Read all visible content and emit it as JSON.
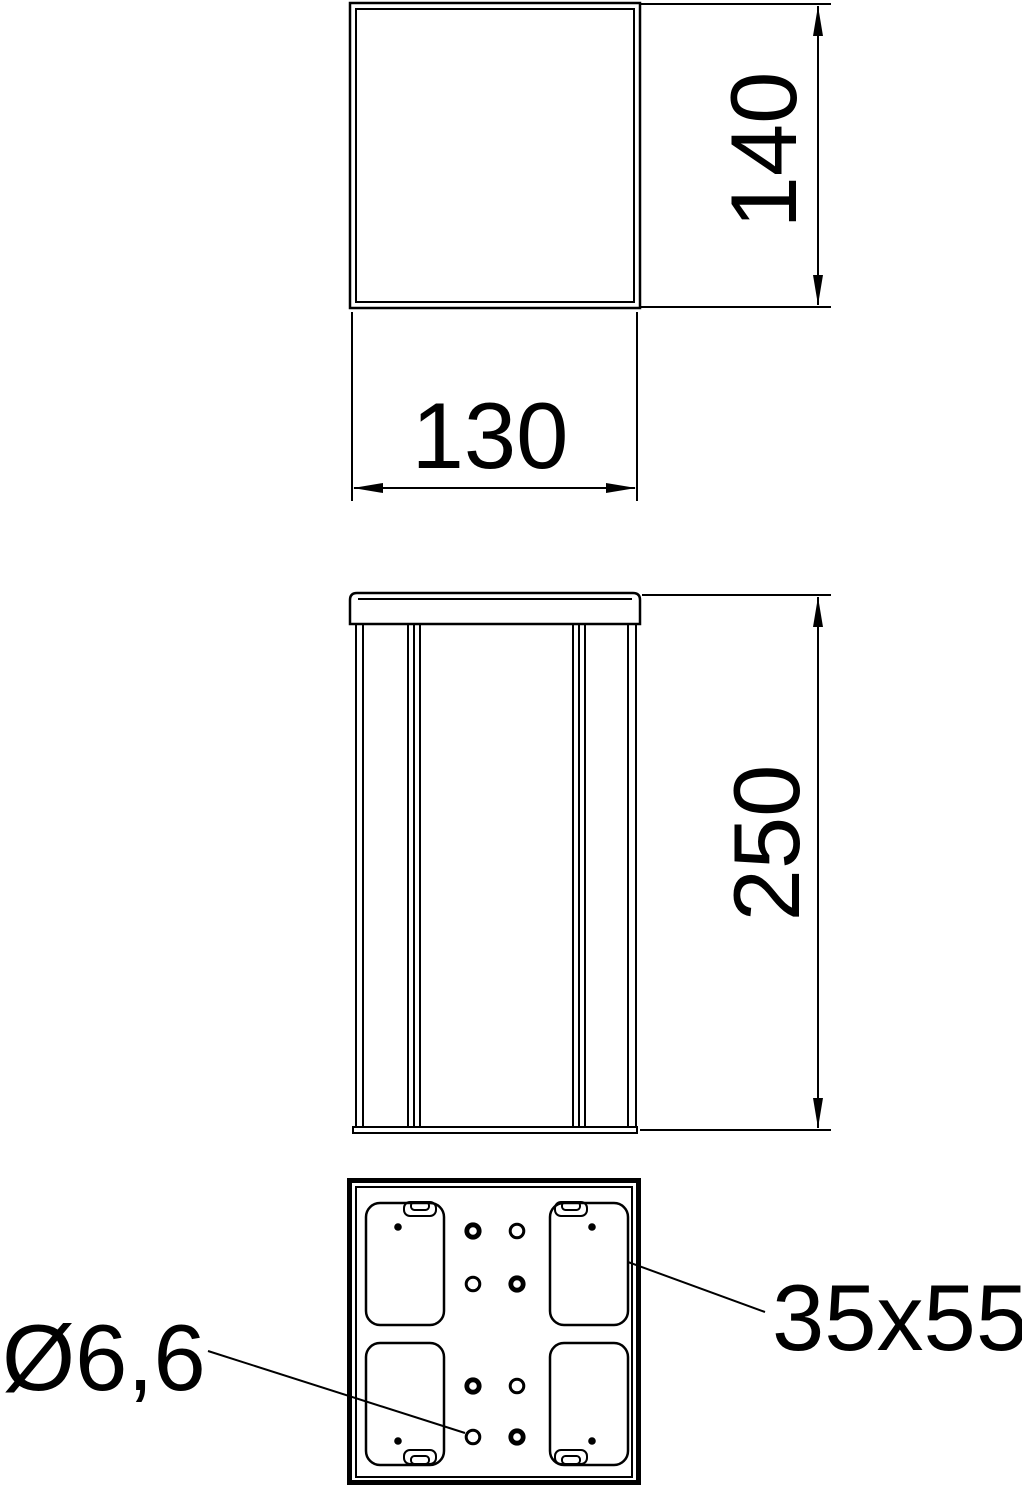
{
  "colors": {
    "background": "#ffffff",
    "line": "#000000"
  },
  "dimensions": {
    "top_view_height": "140",
    "top_view_width": "130",
    "front_view_height": "250"
  },
  "labels": {
    "hole_diameter": "Ø6,6",
    "cutout_size": "35x55"
  }
}
